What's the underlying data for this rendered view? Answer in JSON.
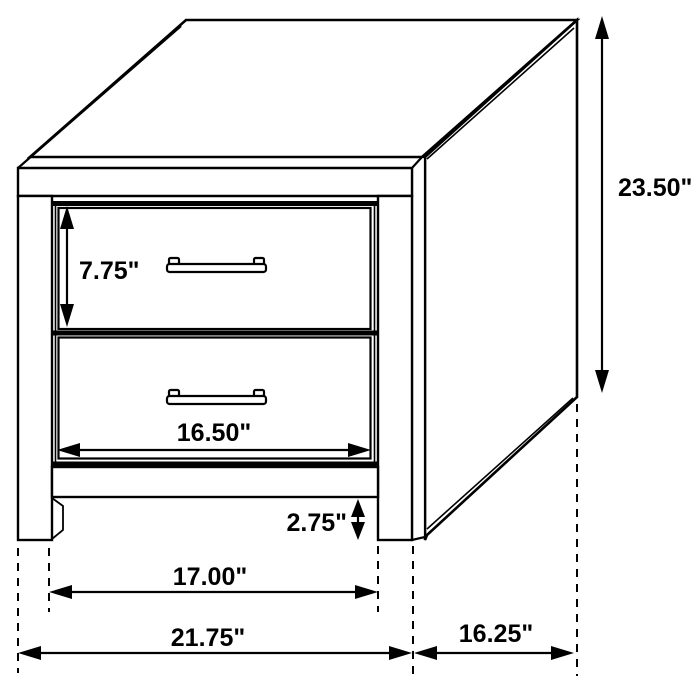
{
  "diagram": {
    "object": "two-drawer nightstand",
    "view": "three-quarter front line drawing with dimension arrows",
    "units": "inches",
    "colors": {
      "line": "#000000",
      "text": "#000000",
      "background": "#ffffff"
    },
    "dimensions": {
      "overall_height": {
        "label": "23.50\"",
        "value": 23.5,
        "measures": "overall height"
      },
      "top_drawer_height": {
        "label": "7.75\"",
        "value": 7.75,
        "measures": "drawer front height"
      },
      "drawer_width": {
        "label": "16.50\"",
        "value": 16.5,
        "measures": "drawer width"
      },
      "base_height": {
        "label": "2.75\"",
        "value": 2.75,
        "measures": "base leg height"
      },
      "leg_spacing": {
        "label": "17.00\"",
        "value": 17.0,
        "measures": "width between legs"
      },
      "overall_width": {
        "label": "21.75\"",
        "value": 21.75,
        "measures": "overall width"
      },
      "overall_depth": {
        "label": "16.25\"",
        "value": 16.25,
        "measures": "overall depth"
      }
    }
  }
}
